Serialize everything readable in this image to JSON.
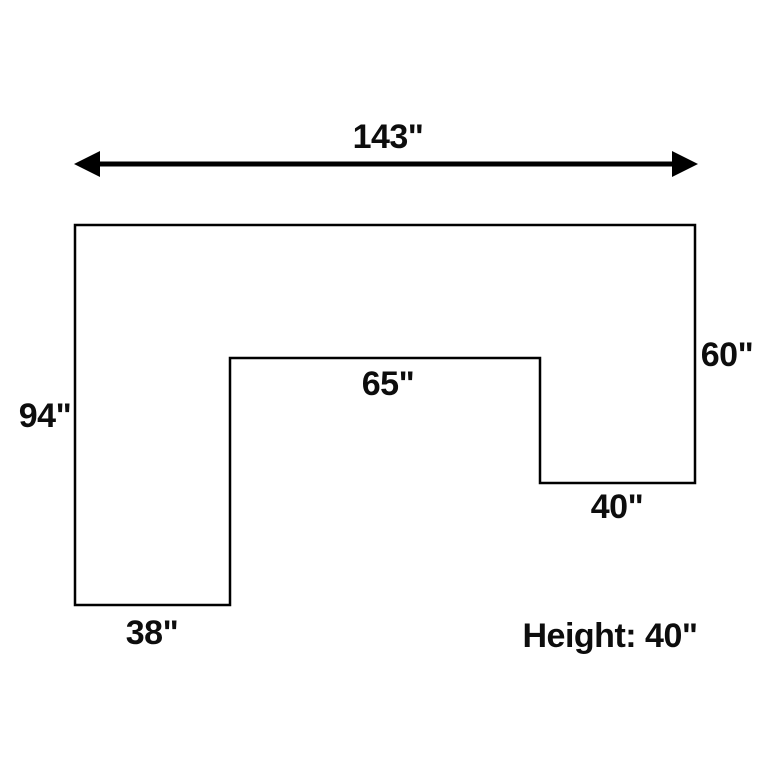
{
  "diagram": {
    "type": "dimension-diagram",
    "background_color": "#ffffff",
    "line_color": "#000000",
    "text_color": "#0d0d0d",
    "labels": {
      "total_width": "143\"",
      "left_height": "94\"",
      "right_height": "60\"",
      "inner_width": "65\"",
      "right_arm_width": "40\"",
      "left_leg_width": "38\"",
      "height_note": "Height: 40\""
    },
    "dimensions_inches": {
      "total_width": 143,
      "left_height": 94,
      "right_height": 60,
      "inner_width": 65,
      "right_arm_width": 40,
      "left_leg_width": 38,
      "height": 40
    }
  }
}
